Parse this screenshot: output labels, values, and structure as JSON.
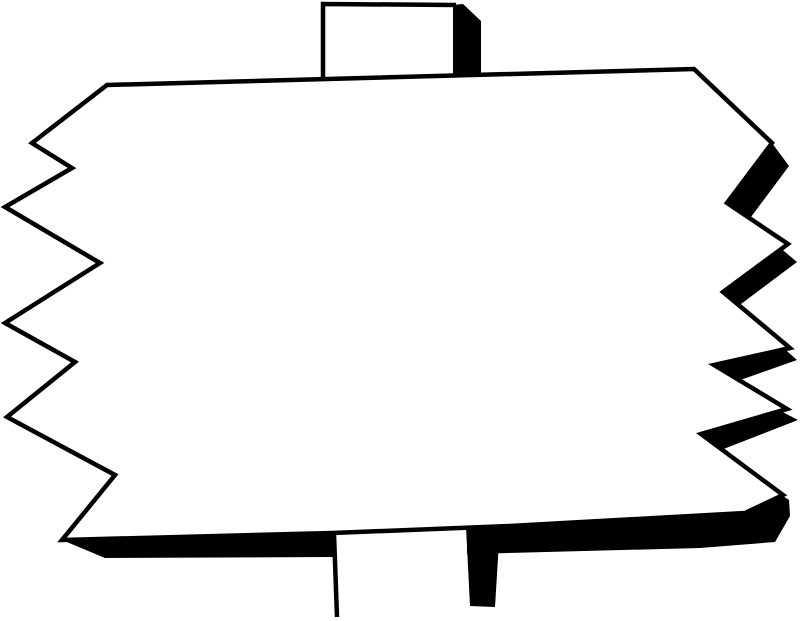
{
  "scene": {
    "title": "Blank jagged-edge sign on a post (black and white clipart)",
    "description": "Hand-drawn blank rectangular sign board with zigzag torn left and right edges, thick black drop shadow on the right and bottom, mounted on a vertical post visible above and below the board",
    "background_color": "#ffffff",
    "ink_color": "#000000",
    "sign_text": ""
  },
  "sign": {
    "board_points": "107,85 694,69 772,143 727,203 788,244 723,292 790,348 714,365 787,409 701,434 783,495 745,513 510,526 332,533 62,540 115,475 7,417 75,362 5,323 100,263 5,207 72,168 32,143",
    "shadow_points": "772,143 727,203 788,244 723,292 790,348 714,365 787,409 701,434 783,495 745,513 510,526 332,533 62,540 105,558 333,557 470,554 700,548 775,542 790,516 789,500 716,452 798,420 729,384 797,360 737,307 797,262 748,221 789,166"
  },
  "top_post": {
    "face_points": "322,3 457,5 457,77 322,79",
    "outline_points": "456,5 323,4 323,78",
    "shadow_points": "453,5 463,4 481,21 481,73 453,74"
  },
  "bottom_post": {
    "face_points": "333,532 467,528 467,621 336,621",
    "edge_points": "334,534 337,617",
    "shadow_points": "466,527 500,525 495,607 470,606"
  }
}
